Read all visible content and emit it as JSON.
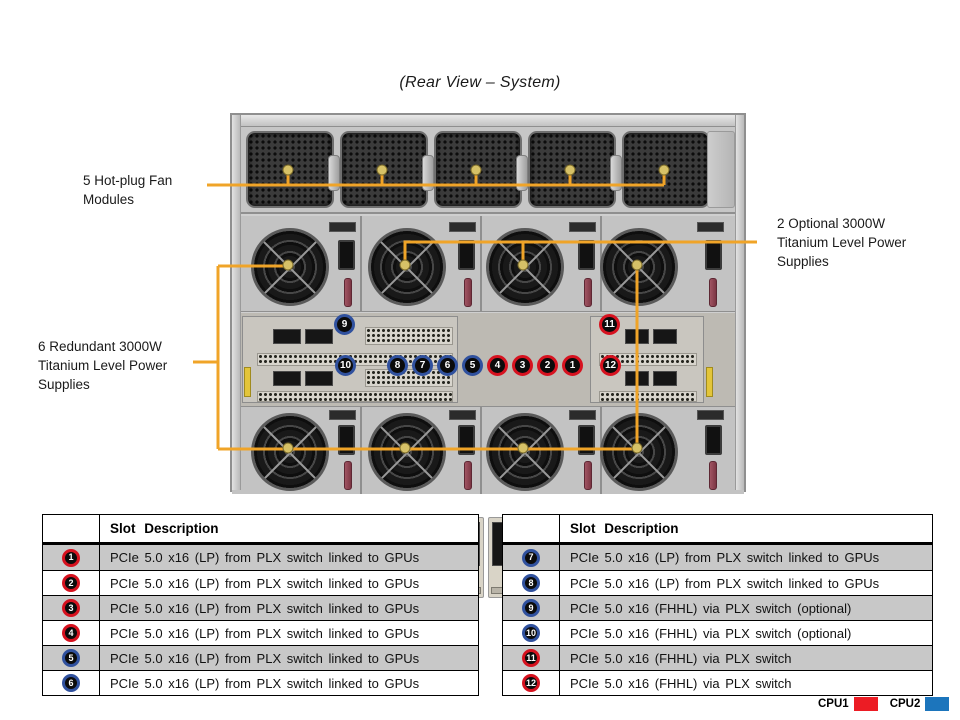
{
  "title": "(Rear View – System)",
  "callouts": {
    "fan": "5 Hot-plug Fan Modules",
    "optional_psu": "2 Optional 3000W Titanium Level Power Supplies",
    "redundant_psu": "6 Redundant 3000W Titanium Level Power Supplies"
  },
  "rear_badges": [
    {
      "n": "9",
      "cpu": "cpu2"
    },
    {
      "n": "10",
      "cpu": "cpu2"
    },
    {
      "n": "8",
      "cpu": "cpu2"
    },
    {
      "n": "7",
      "cpu": "cpu2"
    },
    {
      "n": "6",
      "cpu": "cpu2"
    },
    {
      "n": "5",
      "cpu": "cpu2"
    },
    {
      "n": "4",
      "cpu": "cpu1"
    },
    {
      "n": "3",
      "cpu": "cpu1"
    },
    {
      "n": "2",
      "cpu": "cpu1"
    },
    {
      "n": "1",
      "cpu": "cpu1"
    },
    {
      "n": "11",
      "cpu": "cpu1"
    },
    {
      "n": "12",
      "cpu": "cpu1"
    }
  ],
  "tables": [
    {
      "header": {
        "slot": "",
        "description": "Slot Description"
      },
      "rows": [
        {
          "slot": "1",
          "cpu": "cpu1",
          "desc": "PCIe 5.0 x16 (LP) from PLX switch linked to GPUs"
        },
        {
          "slot": "2",
          "cpu": "cpu1",
          "desc": "PCIe 5.0 x16 (LP) from PLX switch linked to GPUs"
        },
        {
          "slot": "3",
          "cpu": "cpu1",
          "desc": "PCIe 5.0 x16 (LP) from PLX switch linked to GPUs"
        },
        {
          "slot": "4",
          "cpu": "cpu1",
          "desc": "PCIe 5.0 x16 (LP) from PLX switch linked to GPUs"
        },
        {
          "slot": "5",
          "cpu": "cpu2",
          "desc": "PCIe 5.0 x16 (LP) from PLX switch linked to GPUs"
        },
        {
          "slot": "6",
          "cpu": "cpu2",
          "desc": "PCIe 5.0 x16 (LP) from PLX switch linked to GPUs"
        }
      ]
    },
    {
      "header": {
        "slot": "",
        "description": "Slot Description"
      },
      "rows": [
        {
          "slot": "7",
          "cpu": "cpu2",
          "desc": "PCIe 5.0 x16 (LP) from PLX switch linked to GPUs"
        },
        {
          "slot": "8",
          "cpu": "cpu2",
          "desc": "PCIe 5.0 x16 (LP) from PLX switch linked to GPUs"
        },
        {
          "slot": "9",
          "cpu": "cpu2",
          "desc": "PCIe 5.0 x16 (FHHL) via PLX switch (optional)"
        },
        {
          "slot": "10",
          "cpu": "cpu2",
          "desc": "PCIe 5.0 x16 (FHHL) via PLX switch (optional)"
        },
        {
          "slot": "11",
          "cpu": "cpu1",
          "desc": "PCIe 5.0 x16 (FHHL) via PLX switch"
        },
        {
          "slot": "12",
          "cpu": "cpu1",
          "desc": "PCIe 5.0 x16 (FHHL) via PLX switch"
        }
      ]
    }
  ],
  "legend": [
    {
      "label": "CPU1",
      "color": "#EC1C24"
    },
    {
      "label": "CPU2",
      "color": "#1C75BC"
    }
  ],
  "colors": {
    "callout": "#F0A428",
    "cpu1": "#EC1C24",
    "cpu2": "#1C75BC",
    "badge-red": "#D6121F",
    "badge-blue": "#30519E",
    "table-row-alt": "#C8C8C8"
  }
}
